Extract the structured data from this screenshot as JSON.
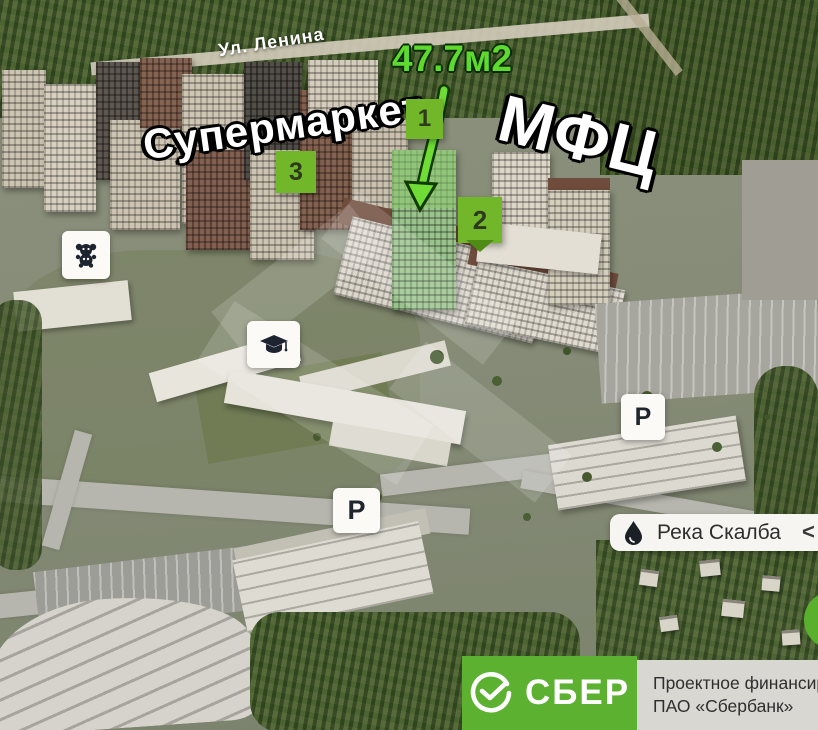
{
  "annotations": {
    "street_label": "Ул. Ленина",
    "area_label": "47.7м2",
    "supermarket_label": "Супермаркет",
    "mfc_label": "МФЦ",
    "badges": [
      "1",
      "2",
      "3"
    ]
  },
  "markers": {
    "kindergarten_icon": "teddy-bear",
    "school_icon": "graduation-cap",
    "parking_letter": "P"
  },
  "river_card": {
    "icon": "water-drop",
    "label": "Река Скалба",
    "chevron": "<"
  },
  "sber_banner": {
    "logo_icon": "sber-check",
    "brand": "СБЕР",
    "financing_line1": "Проектное финансирование",
    "financing_line2": "ПАО «Сбербанк»"
  },
  "colors": {
    "highlight_green": "#5ed930",
    "badge_green": "#72b62a",
    "sber_green": "#5cb130",
    "panel_gray": "#d8d7d2"
  }
}
